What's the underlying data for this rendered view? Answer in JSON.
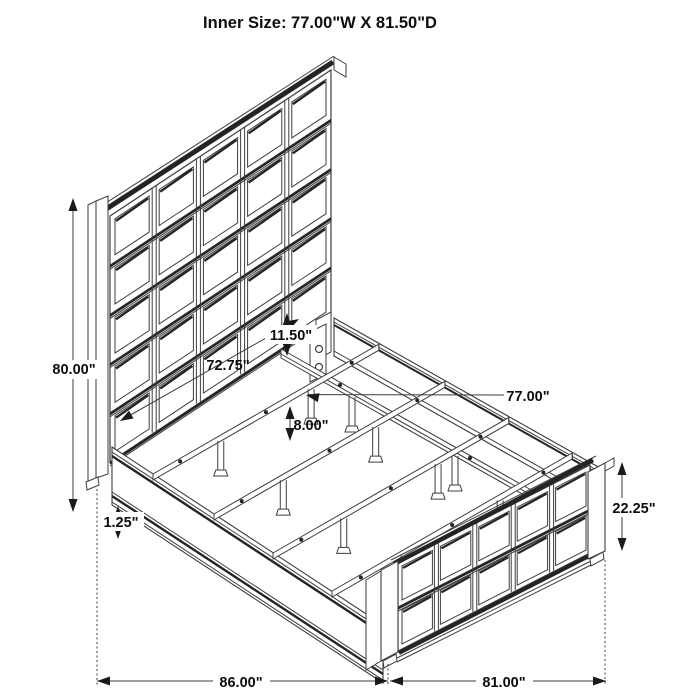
{
  "title": "Inner Size: 77.00\"W X 81.50\"D",
  "diagram": {
    "subject": "bed-frame-isometric-line-drawing",
    "parts": [
      "headboard-grid-panel",
      "left-side-rail",
      "right-side-rail",
      "center-support-rail",
      "slats-with-legs",
      "footboard-grid-panel"
    ]
  },
  "dimensions": {
    "overall_height": "80.00\"",
    "rail_inner_length": "72.75\"",
    "side_rail_height": "11.50\"",
    "inner_width": "77.00\"",
    "slat_leg_height": "8.00\"",
    "rail_lip_thickness": "1.25\"",
    "footboard_height": "22.25\"",
    "overall_depth": "86.00\"",
    "footboard_width": "81.00\""
  },
  "colors": {
    "line": "#3e3e3e",
    "dark_line": "#242424",
    "arrow": "#1a1a1a",
    "text": "#0d0d0d",
    "background": "#ffffff"
  }
}
